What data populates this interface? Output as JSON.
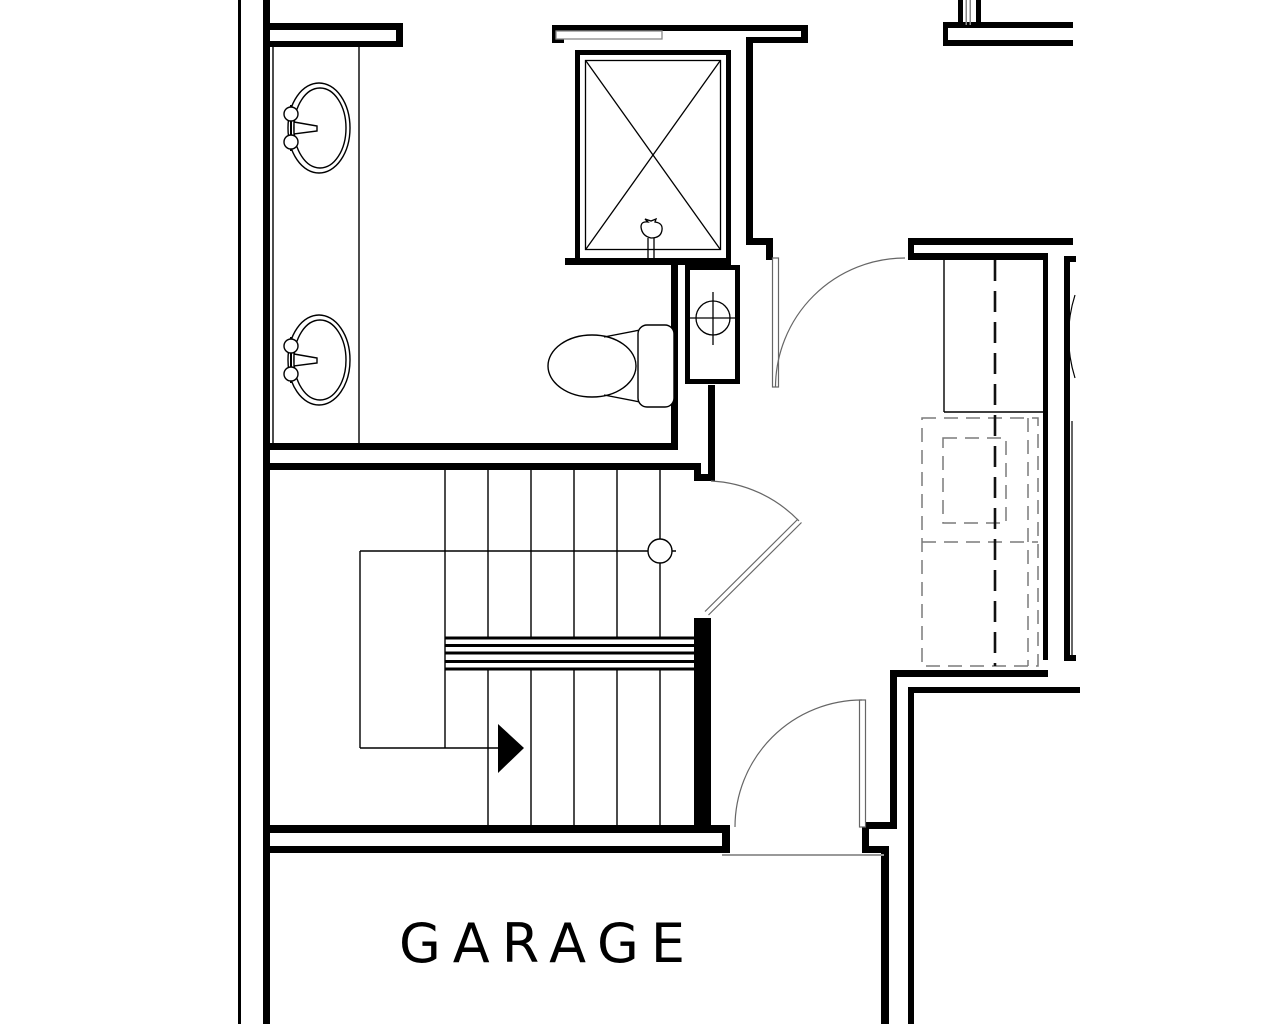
{
  "drawing": {
    "type": "floor-plan",
    "room_label": "GARAGE",
    "colors": {
      "wall_line": "#000000",
      "door_line": "#666666",
      "dashed_line": "#7a7a7a",
      "threshold_line": "#999999"
    },
    "fixtures": [
      "vanity-sink-upper",
      "vanity-sink-lower",
      "shower-stall",
      "toilet",
      "plumbing-chase-drain",
      "stair-run-with-direction-arrow",
      "bath-door-swing",
      "stair-door-swing",
      "garage-door-swing",
      "dashed-understair-outline"
    ]
  }
}
